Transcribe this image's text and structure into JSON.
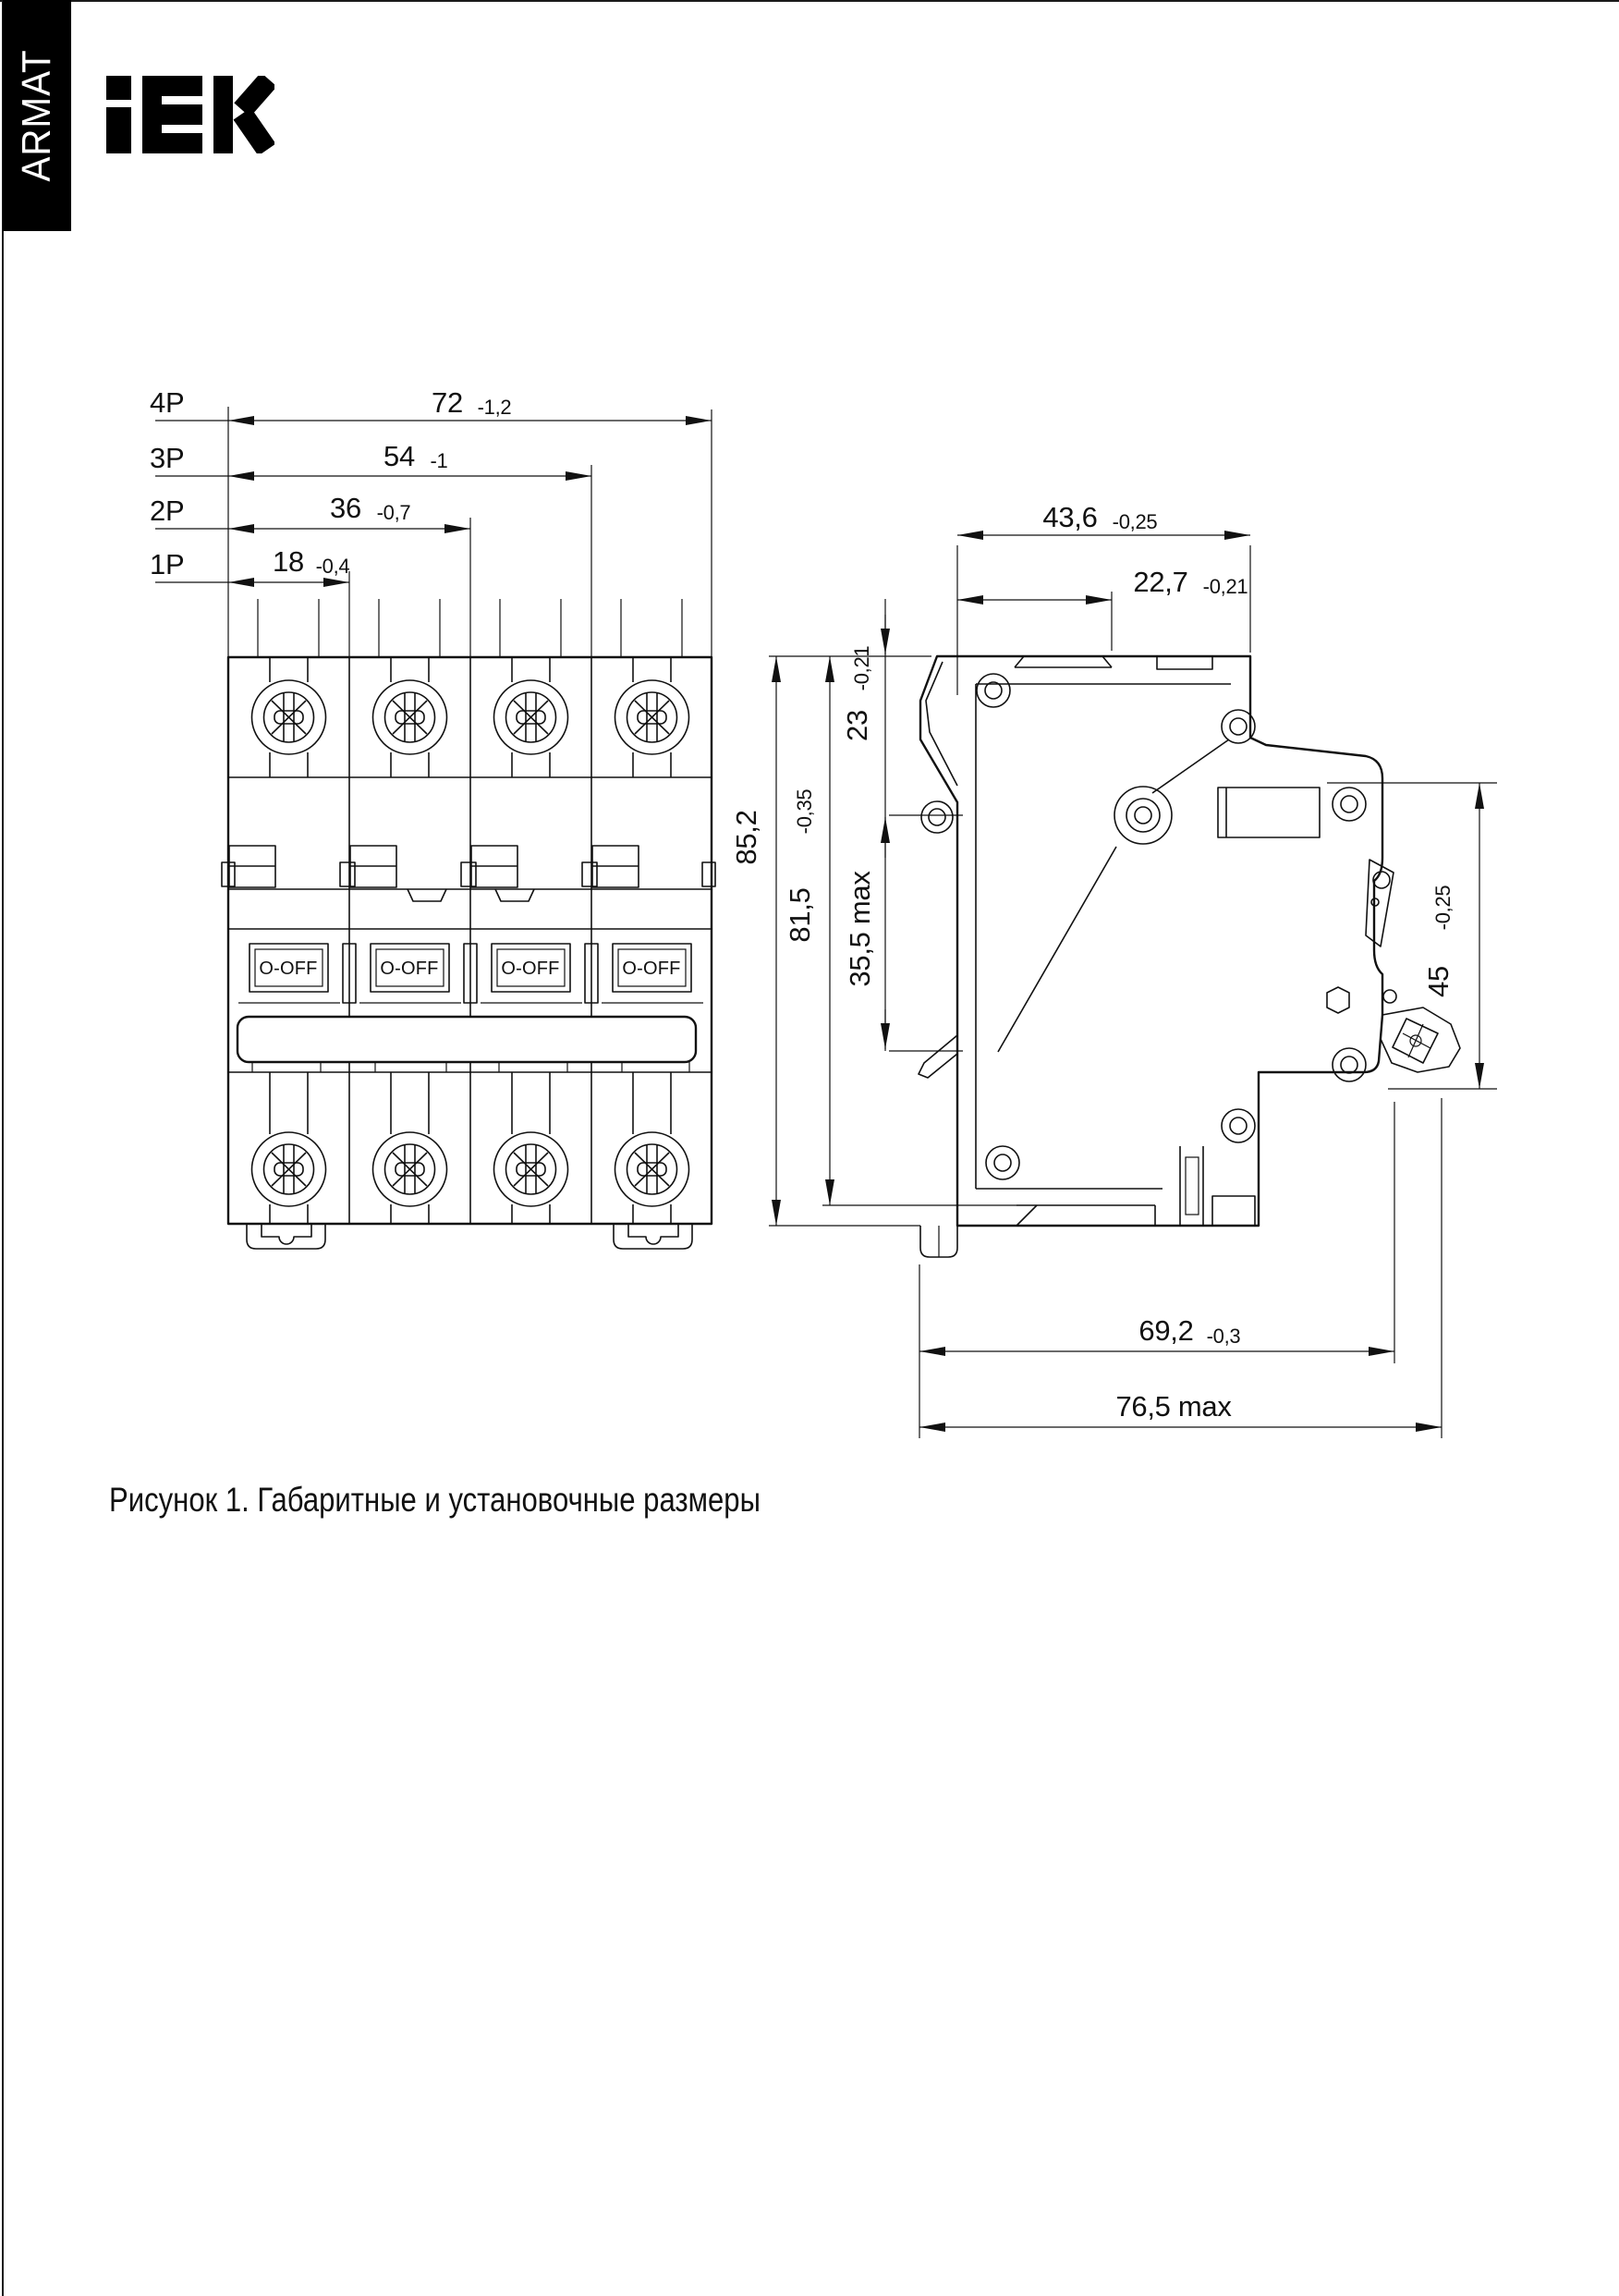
{
  "brand": {
    "armat_label": "ARMAT",
    "iek_logo_name": "IEK"
  },
  "front_view": {
    "dims": [
      {
        "label": "4P",
        "value": "72",
        "tolerance": "-1,2"
      },
      {
        "label": "3P",
        "value": "54",
        "tolerance": "-1"
      },
      {
        "label": "2P",
        "value": "36",
        "tolerance": "-0,7"
      },
      {
        "label": "1P",
        "value": "18",
        "tolerance": "-0,4"
      }
    ],
    "toggle_label": "O-OFF"
  },
  "side_view": {
    "dims": {
      "overall_width": {
        "value": "43,6",
        "tolerance": "-0,25"
      },
      "handle_offset": {
        "value": "22,7",
        "tolerance": "-0,21"
      },
      "handle_top": {
        "value": "23",
        "tolerance": "-0,21"
      },
      "handle_travel": {
        "value": "35,5 max",
        "tolerance": ""
      },
      "overall_height": {
        "value": "85,2",
        "tolerance": ""
      },
      "body_height": {
        "value": "81,5",
        "tolerance": "-0,35"
      },
      "din_rail": {
        "value": "45",
        "tolerance": "-0,25"
      },
      "depth": {
        "value": "69,2",
        "tolerance": "-0,3"
      },
      "depth_max": {
        "value": "76,5 max",
        "tolerance": ""
      }
    }
  },
  "caption": "Рисунок 1. Габаритные и установочные размеры",
  "colors": {
    "ink": "#111111",
    "paper": "#ffffff",
    "brand_bg": "#000000"
  }
}
